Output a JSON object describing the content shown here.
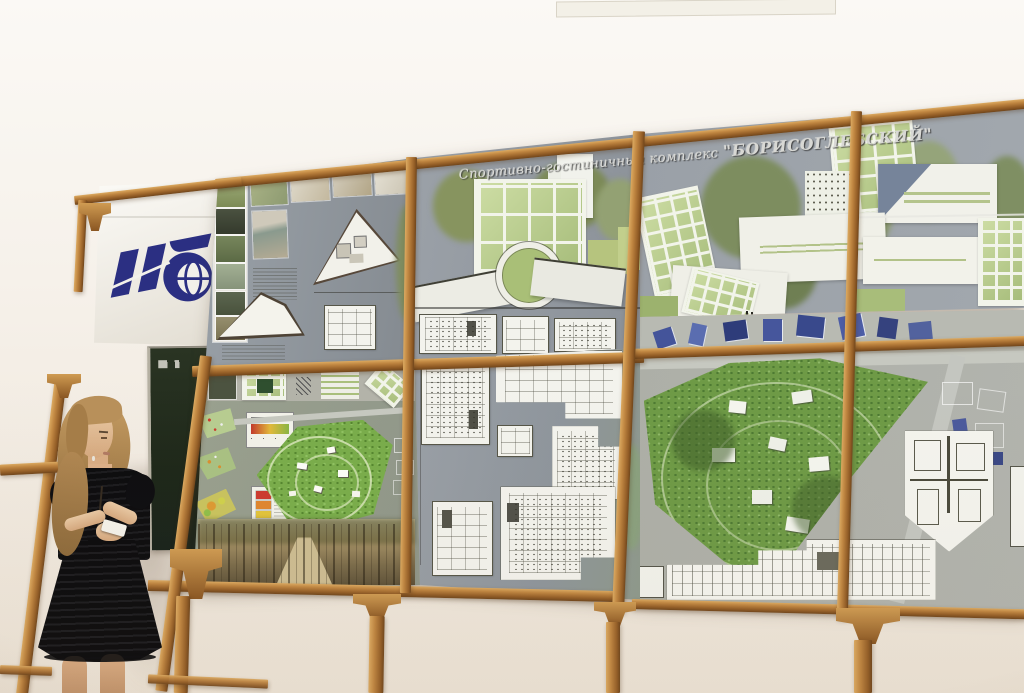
{
  "scene": {
    "setting": "Architectural diploma project presentation on a wooden display stand",
    "title": {
      "part1": "Спортивно-гостиничный комплекс",
      "part2": "\"БОРИСОГЛЕБСКИЙ\""
    },
    "banner": {
      "logo_monogram": "ИГ"
    },
    "boards": {
      "top_left": "Site photos, interior photos, triangular floor plan and section",
      "top_center": "Main facade rendering with green glass grid and ramp",
      "top_right": "Perspective renderings of tilted green glass volumes",
      "bottom_left": "Site analysis maps, master plan of park and forest panorama",
      "bottom_center": "Floor plans on grey field",
      "bottom_right": "Aerial view of forested site with overlaid plans and section"
    },
    "legend_gradient_colors": [
      "#c23a2c",
      "#e2b93b",
      "#89b544"
    ],
    "legend_swatch_colors": [
      "#cc3b2f",
      "#e0862f",
      "#e2c43b",
      "#8fbf4a"
    ]
  },
  "colors": {
    "wall": "#f4efe7",
    "wood": "#a9712f",
    "board_background": "#979da4",
    "render_green": "#b9cc92",
    "park_green": "#79ad4b",
    "logo_blue": "#2b2f82",
    "chalkboard_green": "#24301f",
    "dress_black": "#0c0c0e"
  }
}
